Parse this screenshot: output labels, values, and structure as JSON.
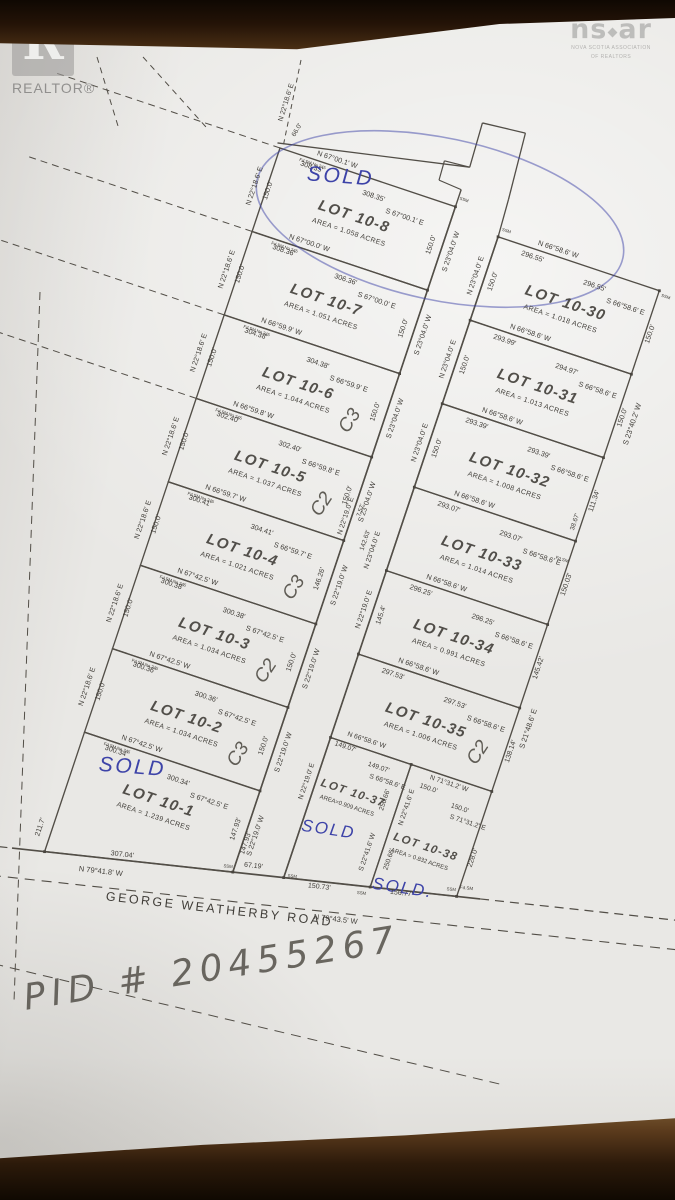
{
  "colors": {
    "ink": "#413e39",
    "line": "#524e47",
    "blue": "#3d43a8",
    "pencil": "#5f5c55",
    "paper": "#e9e8e5"
  },
  "watermarks": {
    "realtor_block_letter": "R",
    "realtor_label": "REALTOR®",
    "nsar_left": "ns",
    "nsar_right": "ar",
    "nsar_sub1": "NOVA SCOTIA ASSOCIATION",
    "nsar_sub2": "OF REALTORS"
  },
  "annotations": {
    "pid": "PID # 20455267"
  },
  "markers": {
    "ssm": "SSM",
    "fdsm": "Fd.SM",
    "fdsm_no": "Fd.SM No.245"
  },
  "road": {
    "name": "GEORGE WEATHERBY ROAD",
    "bearing_left": "N 79°41.8' W",
    "bearing_right": "N 79°43.5' W",
    "crossing": "67.19'",
    "frontage_left": "307.04'",
    "frontage_37": "150.73'",
    "frontage_38": "156.77'"
  },
  "central_road": {
    "width_top": "66.0'",
    "rear_ext_bearing": "N 22°18.6' E",
    "bearing_mid": "N 22°19.0' E",
    "jog": "7.57'",
    "dist_mid": "142.63'",
    "bearing_upper": "N 23°04.0' E"
  },
  "right_margin": {
    "upper": "S 23°40.2' W",
    "lower": "S 21°48.6' E"
  },
  "left_lots": [
    {
      "name": "LOT 10-8",
      "area": "AREA = 1.058 ACRES",
      "note": "SOLD",
      "note_style": "blue",
      "top": {
        "bw": "N 67°00.1' W",
        "d1": "308.35'",
        "d2": "308.35'",
        "be": "S 67°00.1' E"
      },
      "rear_b": "N 22°18.6' E",
      "rear_d": "150.0'",
      "front_b": "S 23°04.0' W",
      "front_d": "150.0'"
    },
    {
      "name": "LOT 10-7",
      "area": "AREA = 1.051 ACRES",
      "top": {
        "bw": "N 67°00.0' W",
        "d1": "308.36'",
        "d2": "306.36'",
        "be": "S 67°00.0' E"
      },
      "rear_b": "N 22°18.6' E",
      "rear_d": "150.0'",
      "front_b": "S 23°04.0' W",
      "front_d": "150.0'"
    },
    {
      "name": "LOT 10-6",
      "area": "AREA = 1.044 ACRES",
      "note": "C3",
      "note_style": "pencil",
      "top": {
        "bw": "N 66°59.9' W",
        "d1": "304.38'",
        "d2": "304.38'",
        "be": "S 66°59.9' E"
      },
      "rear_b": "N 22°18.6' E",
      "rear_d": "150.0'",
      "front_b": "S 23°04.0' W",
      "front_d": "150.0'"
    },
    {
      "name": "LOT 10-5",
      "area": "AREA = 1.037 ACRES",
      "note": "C2",
      "note_style": "pencil",
      "top": {
        "bw": "N 66°59.8' W",
        "d1": "302.40'",
        "d2": "302.40'",
        "be": "S 66°59.8' E"
      },
      "rear_b": "N 22°18.6' E",
      "rear_d": "150.0'",
      "front_b": "S 23°04.0' W",
      "front_d": "150.0'"
    },
    {
      "name": "LOT 10-4",
      "area": "AREA = 1.021 ACRES",
      "note": "C3",
      "note_style": "pencil",
      "top": {
        "bw": "N 66°59.7' W",
        "d1": "300.41'",
        "d2": "304.41'",
        "be": "S 66°59.7' E"
      },
      "rear_b": "N 22°18.6' E",
      "rear_d": "150.0'",
      "front_b": "S 22°19.0' W",
      "front_d": "146.26'"
    },
    {
      "name": "LOT 10-3",
      "area": "AREA = 1.034 ACRES",
      "note": "C2",
      "note_style": "pencil",
      "top": {
        "bw": "N 67°42.5' W",
        "d1": "300.38'",
        "d2": "300.38'",
        "be": "S 67°42.5' E"
      },
      "rear_b": "N 22°18.6' E",
      "rear_d": "150.0'",
      "front_b": "S 22°19.0' W",
      "front_d": "150.0'"
    },
    {
      "name": "LOT 10-2",
      "area": "AREA = 1.034 ACRES",
      "note": "C3",
      "note_style": "pencil",
      "top": {
        "bw": "N 67°42.5' W",
        "d1": "300.36'",
        "d2": "300.36'",
        "be": "S 67°42.5' E"
      },
      "rear_b": "N 22°18.6' E",
      "rear_d": "150.0'",
      "front_b": "S 22°19.0' W",
      "front_d": "150.0'"
    },
    {
      "name": "LOT 10-1",
      "area": "AREA = 1.239 ACRES",
      "note": "SOLD",
      "note_style": "blue",
      "top": {
        "bw": "N 67°42.5' W",
        "d1": "300.34'",
        "d2": "300.34'",
        "be": "S 67°42.5' E"
      },
      "rear_d": "211.7'",
      "front_b": "S 22°19.0' W",
      "front_d": "147.93'",
      "front_d2": "147.93'"
    }
  ],
  "right_lots": [
    {
      "name": "LOT 10-30",
      "area": "AREA = 1.018 ACRES",
      "top": {
        "bw": "N 66°58.6' W",
        "d1": "296.55'",
        "d2": "296.55'",
        "be": "S 66°58.6' E"
      },
      "left_b": "N 23°04.0' E",
      "left_d": "150.0'",
      "right_d": "150.0'"
    },
    {
      "name": "LOT 10-31",
      "area": "AREA = 1.013 ACRES",
      "top": {
        "bw": "N 66°58.6' W",
        "d1": "293.99'",
        "d2": "294.97'",
        "be": "S 66°58.6' E"
      },
      "left_b": "N 23°04.0' E",
      "left_d": "150.0'",
      "right_d": "150.0'"
    },
    {
      "name": "LOT 10-32",
      "area": "AREA = 1.008 ACRES",
      "top": {
        "bw": "N 66°58.6' W",
        "d1": "293.39'",
        "d2": "293.39'",
        "be": "S 66°58.6' E"
      },
      "left_b": "N 23°04.0' E",
      "left_d": "150.0'",
      "right_d": "111.34'",
      "right_d2": "38.67'"
    },
    {
      "name": "LOT 10-33",
      "area": "AREA = 1.014 ACRES",
      "top": {
        "bw": "N 66°58.6' W",
        "d1": "293.07'",
        "d2": "293.07'",
        "be": "S 66°58.6' E"
      },
      "right_d": "150.03'"
    },
    {
      "name": "LOT 10-34",
      "area": "AREA = 0.991 ACRES",
      "top": {
        "bw": "N 66°58.6' W",
        "d1": "296.25'",
        "d2": "296.25'",
        "be": "S 66°58.6' E"
      },
      "left_b": "N 22°19.0' E",
      "left_d": "145.4'",
      "right_d": "145.42'"
    },
    {
      "name": "LOT 10-35",
      "area": "AREA = 1.006 ACRES",
      "note": "C2",
      "note_style": "pencil",
      "top": {
        "bw": "N 66°58.6' W",
        "d1": "297.53'",
        "d2": "297.53'",
        "be": "S 66°58.6' E"
      },
      "right_d": "138.14'"
    }
  ],
  "bottom_lots": [
    {
      "name": "LOT 10-37",
      "area": "AREA=0.909 ACRES",
      "note": "SOLD",
      "note_style": "blue",
      "top": {
        "bw": "N 66°58.6' W",
        "d1": "149.07'",
        "d2": "149.07'",
        "be": "S 66°58.6' E"
      },
      "left_b": "N 22°19.0' E",
      "div_b": "S 22°41.6' W",
      "div_d": "250.66'"
    },
    {
      "name": "LOT 10-38",
      "area": "AREA = 0.832 ACRES",
      "note": "SOLD.",
      "note_style": "blue",
      "top": {
        "bw": "N 71°31.2' W",
        "d1": "150.0'",
        "d2": "150.0'",
        "be": "S 71°31.2' E"
      },
      "div_b": "N 22°41.6' E",
      "div_d": "250.66'",
      "right_d": "228.0'"
    }
  ]
}
